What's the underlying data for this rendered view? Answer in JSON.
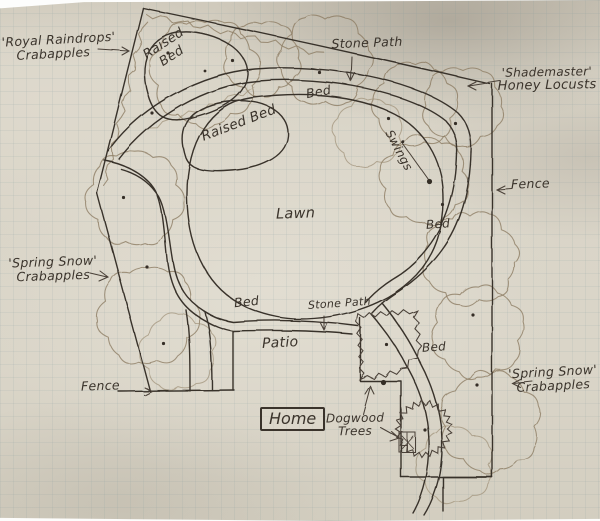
{
  "labels": {
    "royal_raindrops": {
      "line1": "'Royal Raindrops'",
      "line2": "Crabapples"
    },
    "raised_bed_top": {
      "line1": "Raised",
      "line2": "Bed"
    },
    "stone_path_top": {
      "text": "Stone Path"
    },
    "shademaster": {
      "line1": "'Shademaster'",
      "line2": "Honey Locusts"
    },
    "bed_top": {
      "text": "Bed"
    },
    "raised_bed_center": {
      "text": "Raised Bed"
    },
    "lawn": {
      "text": "Lawn"
    },
    "swings": {
      "text": "Swings"
    },
    "fence_right": {
      "text": "Fence"
    },
    "bed_right": {
      "text": "Bed"
    },
    "spring_snow_left": {
      "line1": "'Spring Snow'",
      "line2": "Crabapples"
    },
    "bed_bottom_left": {
      "text": "Bed"
    },
    "stone_path_bottom": {
      "text": "Stone Path"
    },
    "patio": {
      "text": "Patio"
    },
    "fence_bottom": {
      "text": "Fence"
    },
    "home": {
      "text": "Home"
    },
    "dogwood": {
      "line1": "Dogwood",
      "line2": "Trees"
    },
    "spring_snow_right": {
      "line1": "'Spring Snow'",
      "line2": "Crabapples"
    },
    "bed_bottom_right": {
      "text": "Bed"
    }
  },
  "colors": {
    "paper": "#d9d4c7",
    "ink": "#38312a",
    "pencil": "#8d7d64",
    "grid": "#7d969b"
  }
}
